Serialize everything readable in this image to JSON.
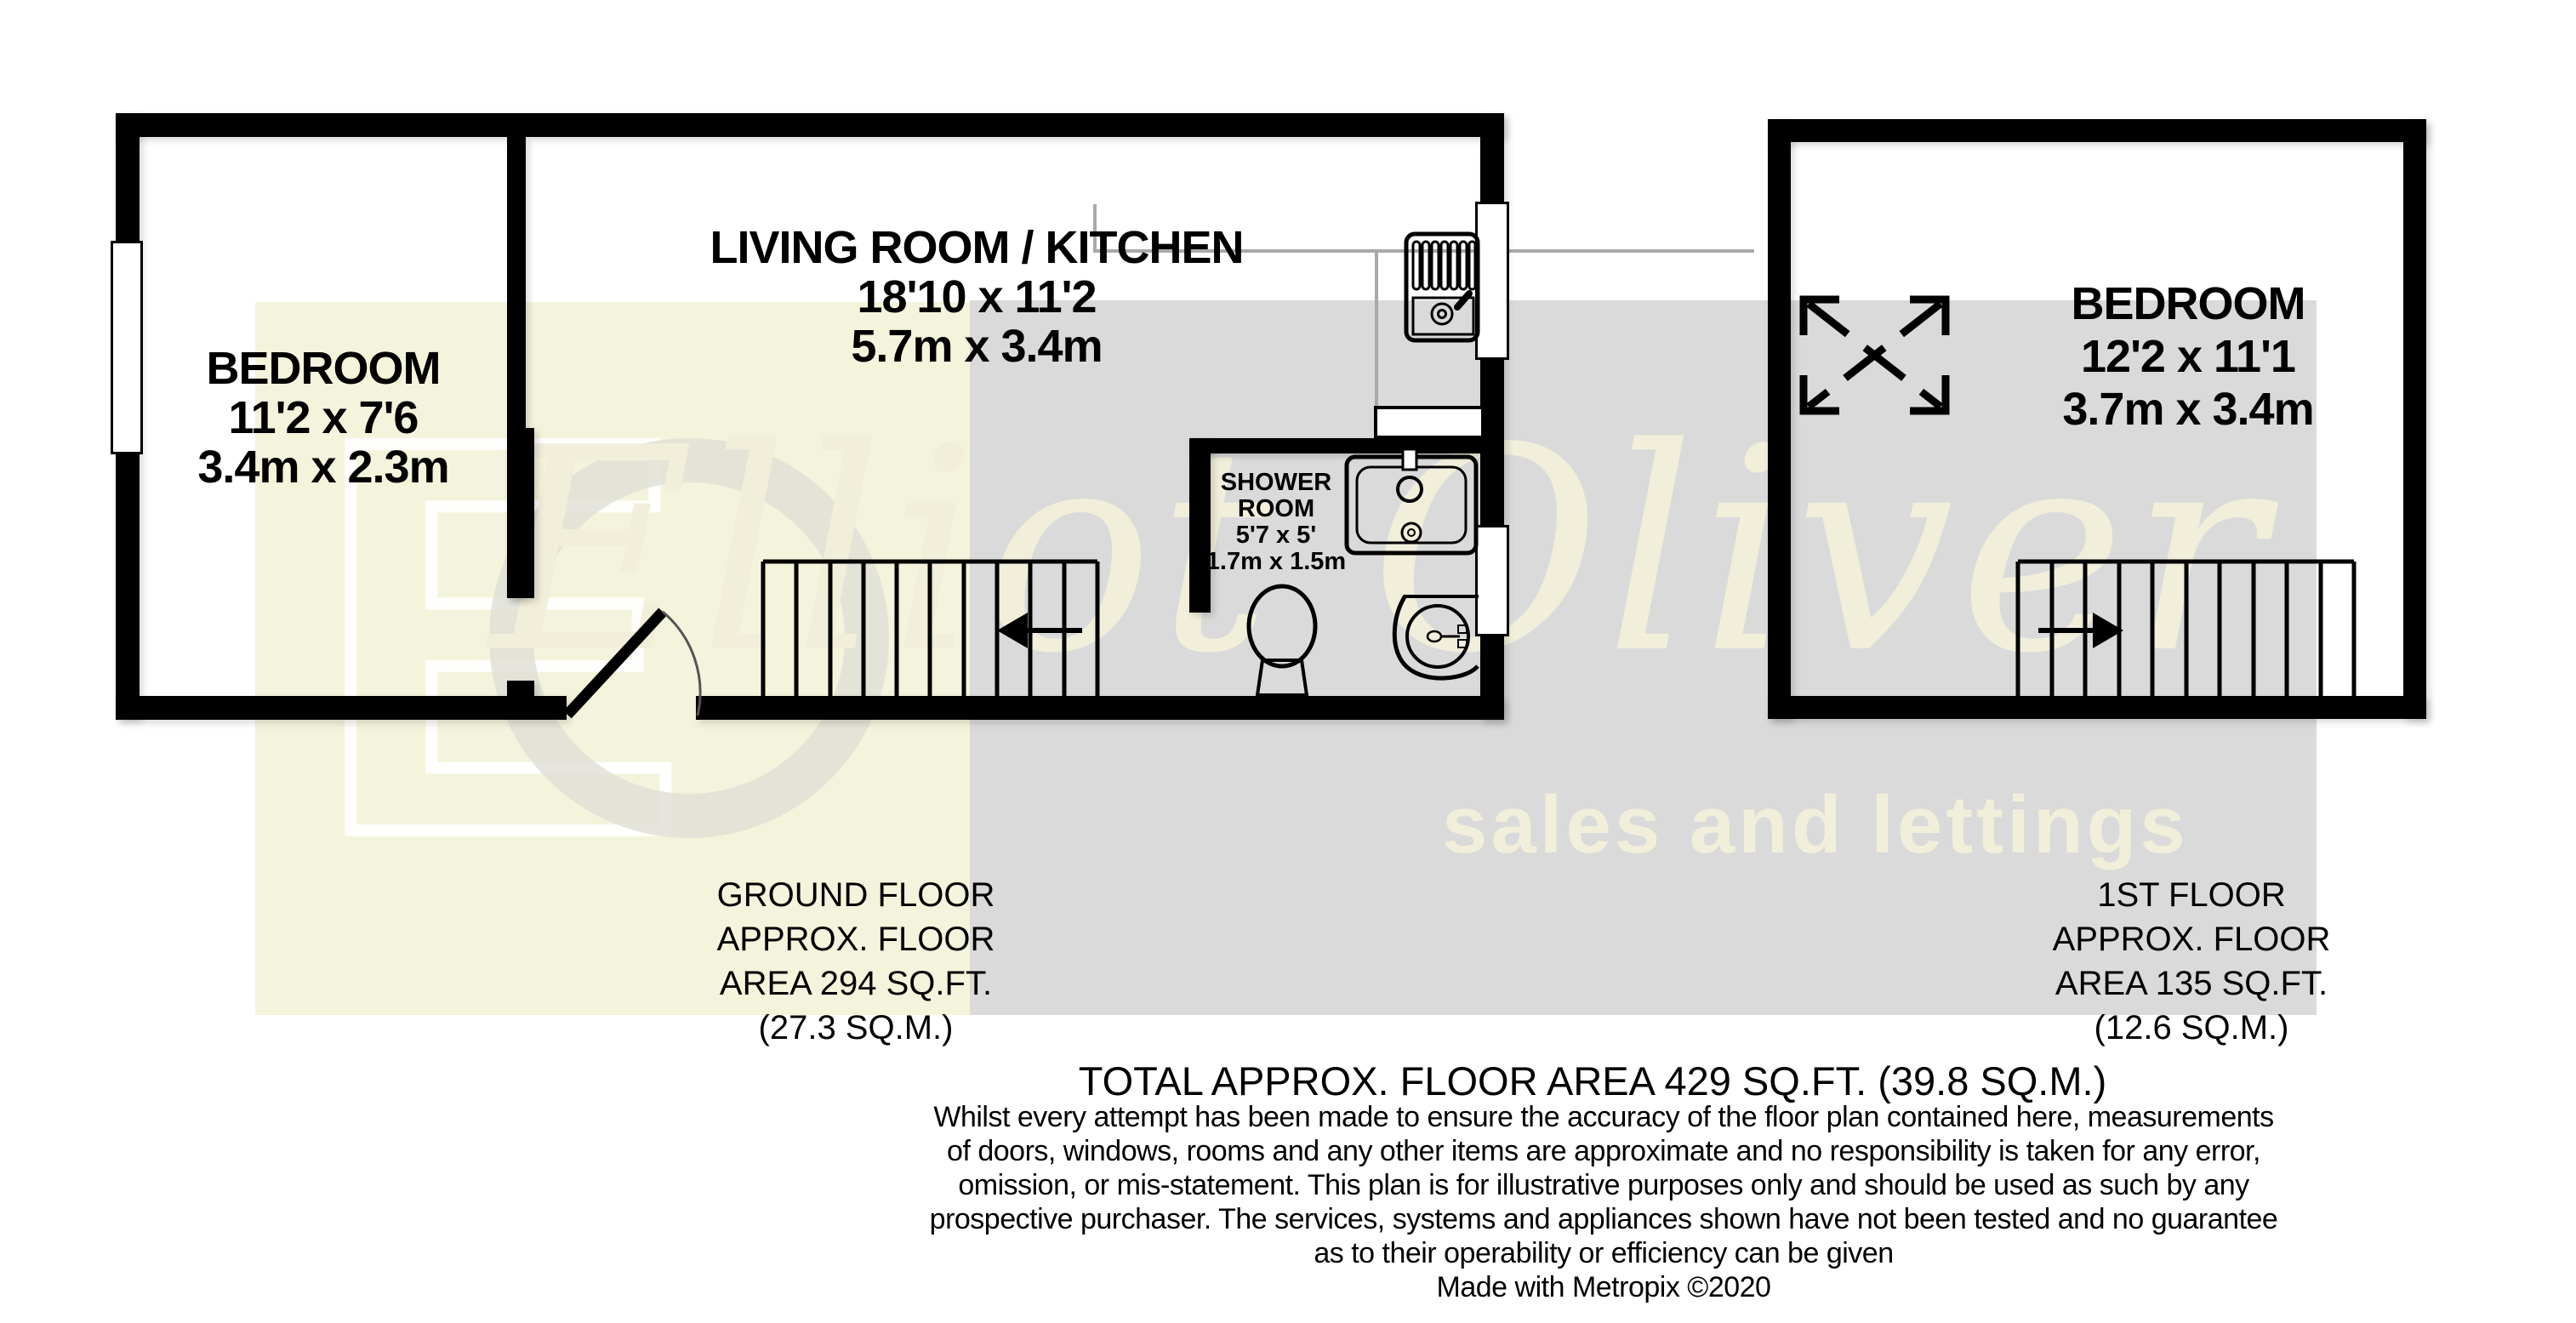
{
  "plan": {
    "ground_floor": {
      "living_kitchen": {
        "name": "LIVING ROOM / KITCHEN",
        "imperial": "18'10 x 11'2",
        "metric": "5.7m x 3.4m"
      },
      "bedroom": {
        "name": "BEDROOM",
        "imperial": "11'2 x 7'6",
        "metric": "3.4m x 2.3m"
      },
      "shower_room": {
        "name_line1": "SHOWER",
        "name_line2": "ROOM",
        "imperial": "5'7 x 5'",
        "metric": "1.7m x 1.5m"
      },
      "summary": {
        "line1": "GROUND FLOOR",
        "line2": "APPROX. FLOOR",
        "line3": "AREA 294 SQ.FT.",
        "line4": "(27.3 SQ.M.)"
      }
    },
    "first_floor": {
      "bedroom": {
        "name": "BEDROOM",
        "imperial": "12'2 x 11'1",
        "metric": "3.7m x 3.4m"
      },
      "summary": {
        "line1": "1ST FLOOR",
        "line2": "APPROX. FLOOR",
        "line3": "AREA 135 SQ.FT.",
        "line4": "(12.6 SQ.M.)"
      }
    },
    "total": "TOTAL APPROX. FLOOR AREA 429 SQ.FT. (39.8 SQ.M.)"
  },
  "watermark": {
    "monogram": "E",
    "brand": "Elliot Oliver",
    "tagline": "sales and lettings"
  },
  "footer": {
    "disclaimer": [
      "Whilst every attempt has been made to ensure the accuracy of the floor plan contained here, measurements",
      "of doors, windows, rooms and any other items are approximate and no responsibility is taken for any error,",
      "omission, or mis-statement. This plan is for illustrative purposes only and should be used as such by any",
      "prospective purchaser. The services, systems and appliances shown have not been tested and no guarantee",
      "as to their operability or efficiency can be given",
      "Made with Metropix ©2020"
    ]
  },
  "colors": {
    "wall": "#000000",
    "watermark_yellow": "#f4f4dc",
    "watermark_gray": "#dadada",
    "watermark_cream": "#f1eeda",
    "background": "#ffffff"
  }
}
